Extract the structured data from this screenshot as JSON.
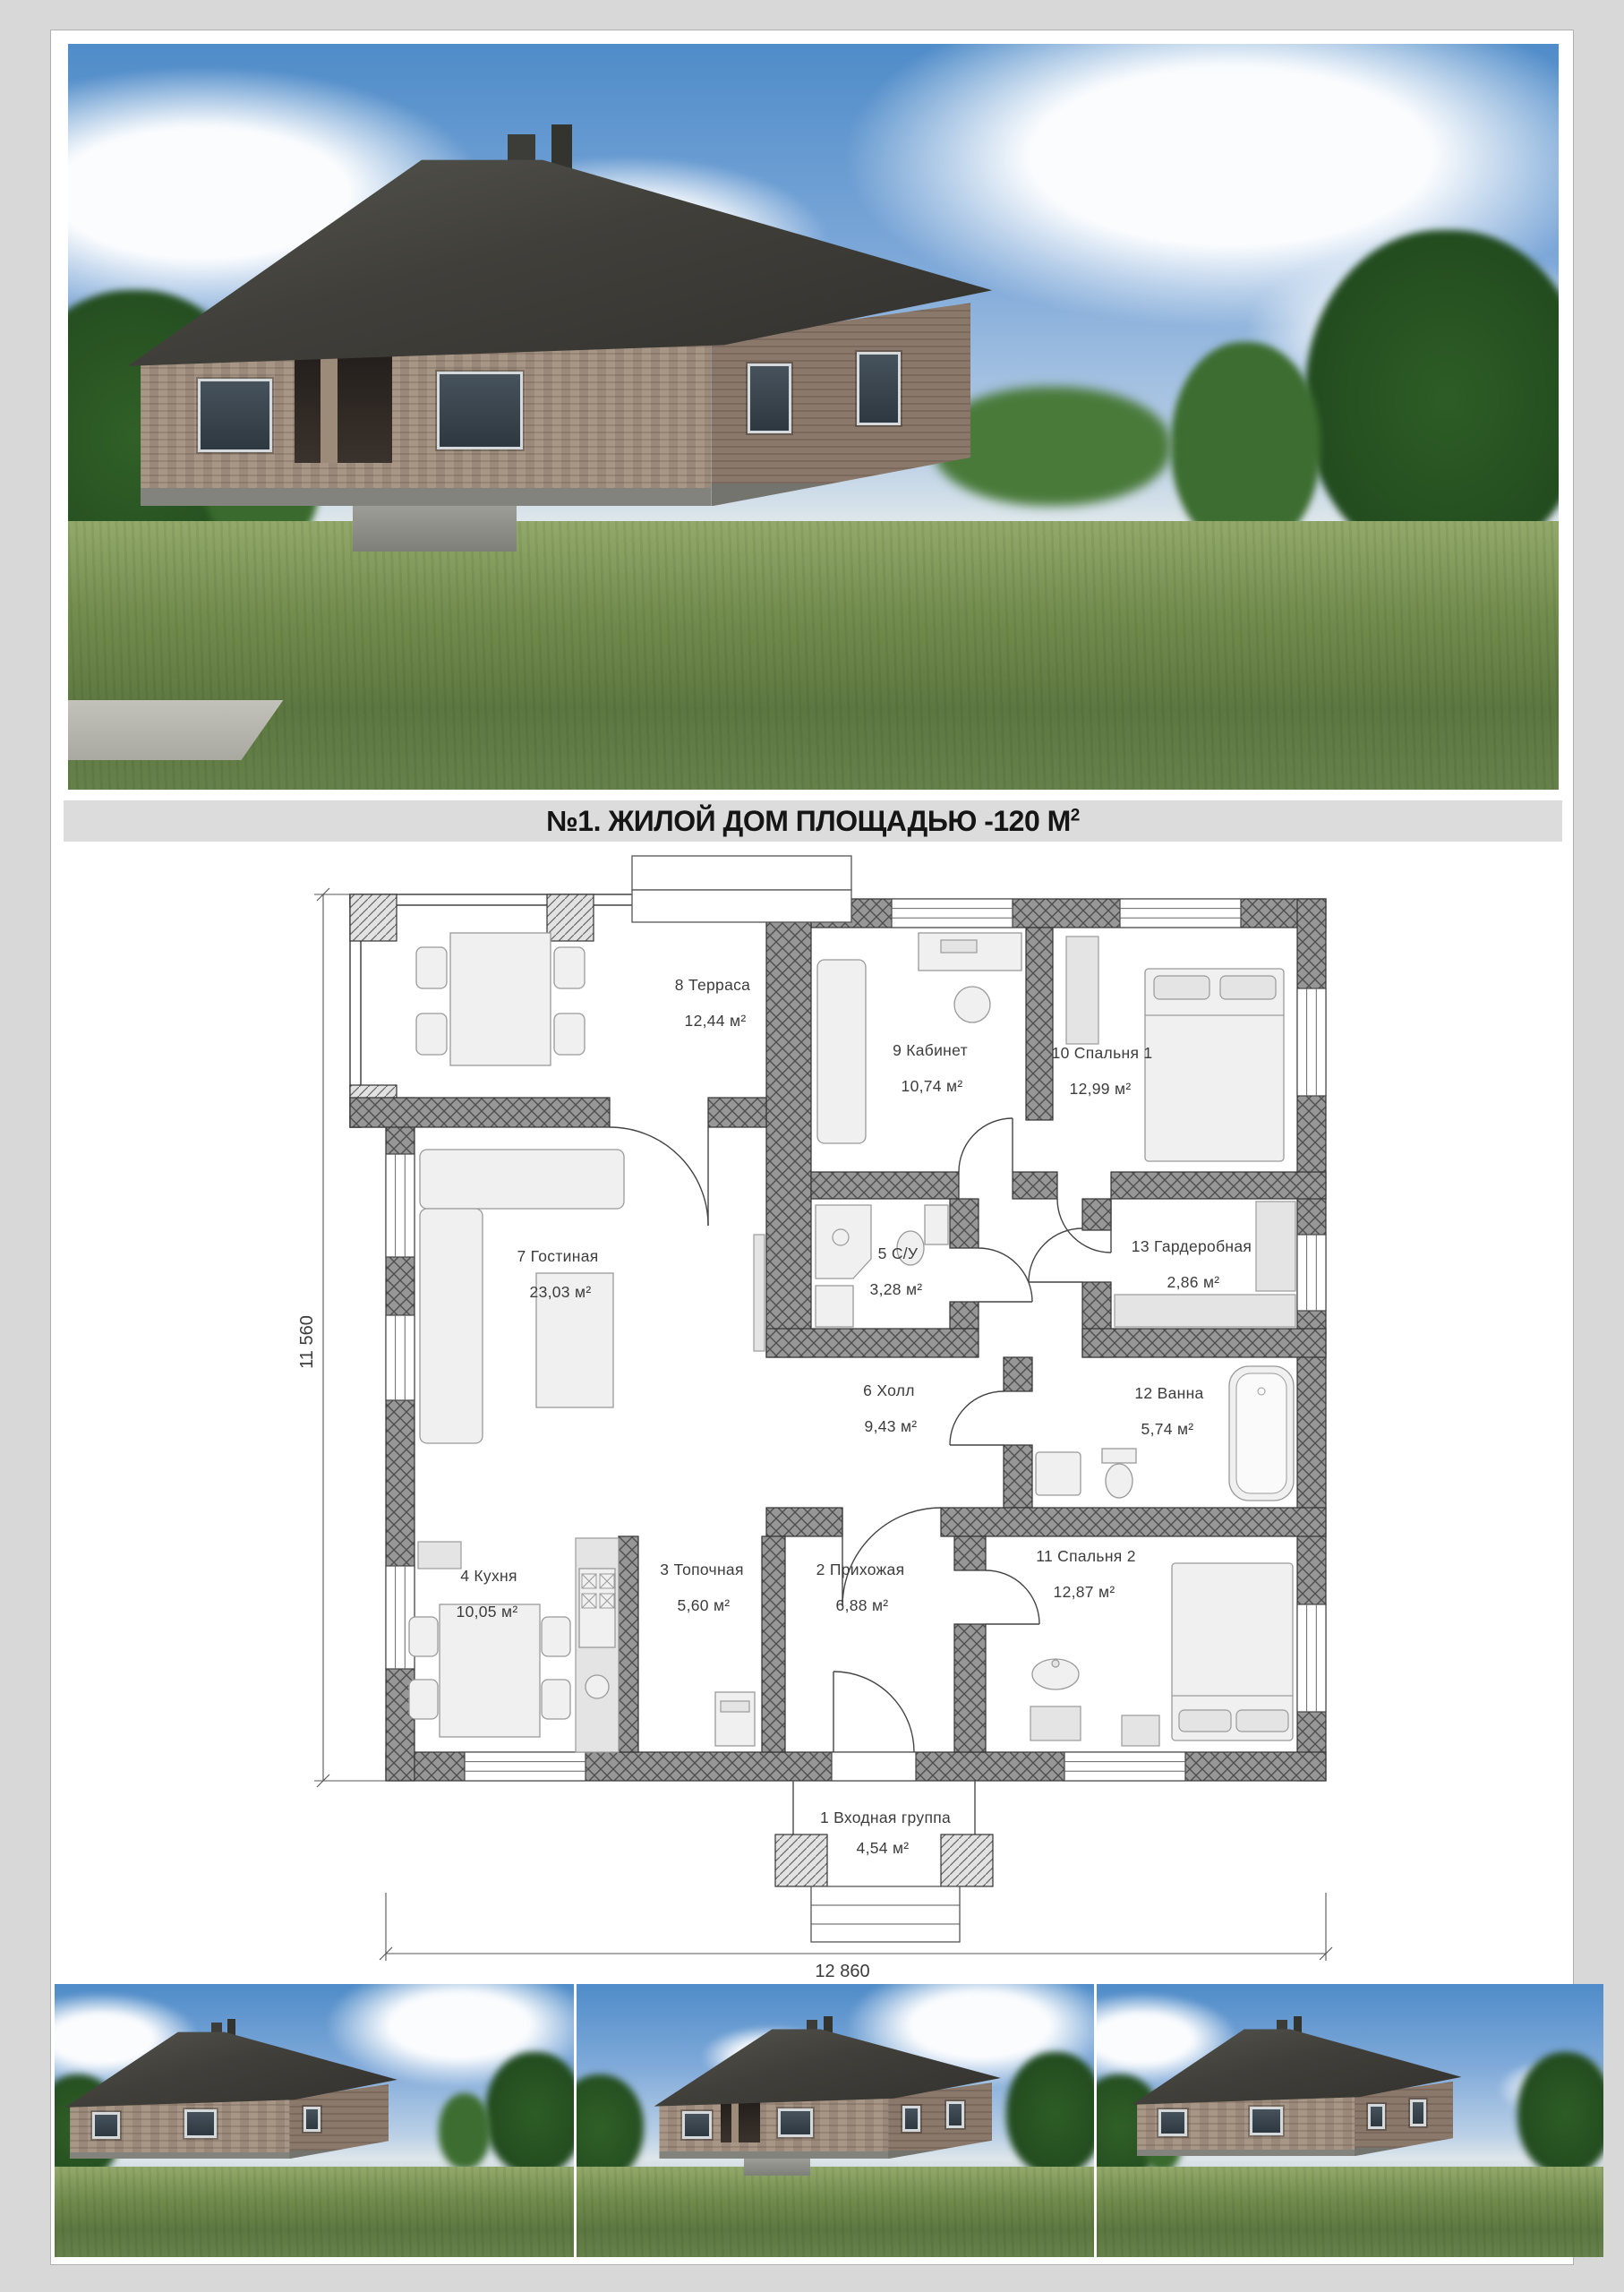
{
  "title": {
    "main": "№1. ЖИЛОЙ ДОМ ПЛОЩАДЬЮ -120 М",
    "sup": "2"
  },
  "plan": {
    "dim_left": "11 560",
    "dim_bottom": "12 860",
    "rooms": [
      {
        "label": "8 Терраса",
        "area": "12,44 м²"
      },
      {
        "label": "9 Кабинет",
        "area": "10,74 м²"
      },
      {
        "label": "10 Спальня 1",
        "area": "12,99 м²"
      },
      {
        "label": "7 Гостиная",
        "area": "23,03 м²"
      },
      {
        "label": "5 С/У",
        "area": "3,28 м²"
      },
      {
        "label": "13 Гардеробная",
        "area": "2,86 м²"
      },
      {
        "label": "6 Холл",
        "area": "9,43 м²"
      },
      {
        "label": "12 Ванна",
        "area": "5,74 м²"
      },
      {
        "label": "4 Кухня",
        "area": "10,05 м²"
      },
      {
        "label": "3 Топочная",
        "area": "5,60 м²"
      },
      {
        "label": "2 Прихожая",
        "area": "6,88 м²"
      },
      {
        "label": "11 Спальня 2",
        "area": "12,87 м²"
      },
      {
        "label": "1 Входная группа",
        "area": "4,54 м²"
      }
    ]
  }
}
